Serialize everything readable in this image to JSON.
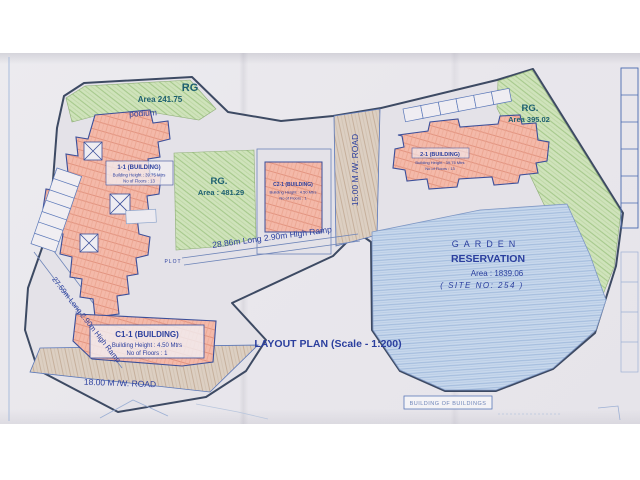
{
  "plan": {
    "title": "LAYOUT PLAN (Scale - 1:200)",
    "footer_box_label": "BUILDING OF BUILDINGS"
  },
  "areas": {
    "rg_top_left": {
      "label": "RG",
      "area": "Area  241.75"
    },
    "rg_center": {
      "label": "RG.",
      "area": "Area : 481.29"
    },
    "rg_right": {
      "label": "RG.",
      "area": "Area  395.02"
    },
    "podium_label": "podium",
    "plot_label": "PLOT",
    "garden": {
      "line1": "GARDEN",
      "line2": "RESERVATION",
      "line3": "Area : 1839.06",
      "line4": "( SITE NO: 254 )"
    }
  },
  "buildings": {
    "b11": {
      "name": "1-1 (BUILDING)",
      "height": "Building Height : 39.75 Mtrs",
      "floors": "No of Floors : 13"
    },
    "c21": {
      "name": "C2-1 (BUILDING)",
      "height": "Building Height : 4.50 Mtrs",
      "floors": "No of Floors : 1"
    },
    "b21": {
      "name": "2-1 (BUILDING)",
      "height": "Building Height : 39.75 Mtrs",
      "floors": "No of Floors : 13"
    },
    "c11": {
      "name": "C1-1 (BUILDING)",
      "height": "Building Height : 4.50 Mtrs",
      "floors": "No of Floors : 1"
    }
  },
  "roads": {
    "road_15": "15.00 M /W. ROAD",
    "road_18": "18.00 M /W. ROAD"
  },
  "ramps": {
    "ramp_28": "28.86m Long 2.90m High Ramp",
    "ramp_27": "27.59m Long 2.90m High Ramp"
  },
  "colors": {
    "label_ink": "#2b3f9e",
    "rg_ink": "#1c5f70",
    "boundary": "#3d4a63",
    "green_fill": "#cfe3bb",
    "building_fill": "#f4b9a9",
    "garden_fill": "#c8d8ec",
    "road_fill": "#dccfc2",
    "paper": "#e9e7ec"
  }
}
